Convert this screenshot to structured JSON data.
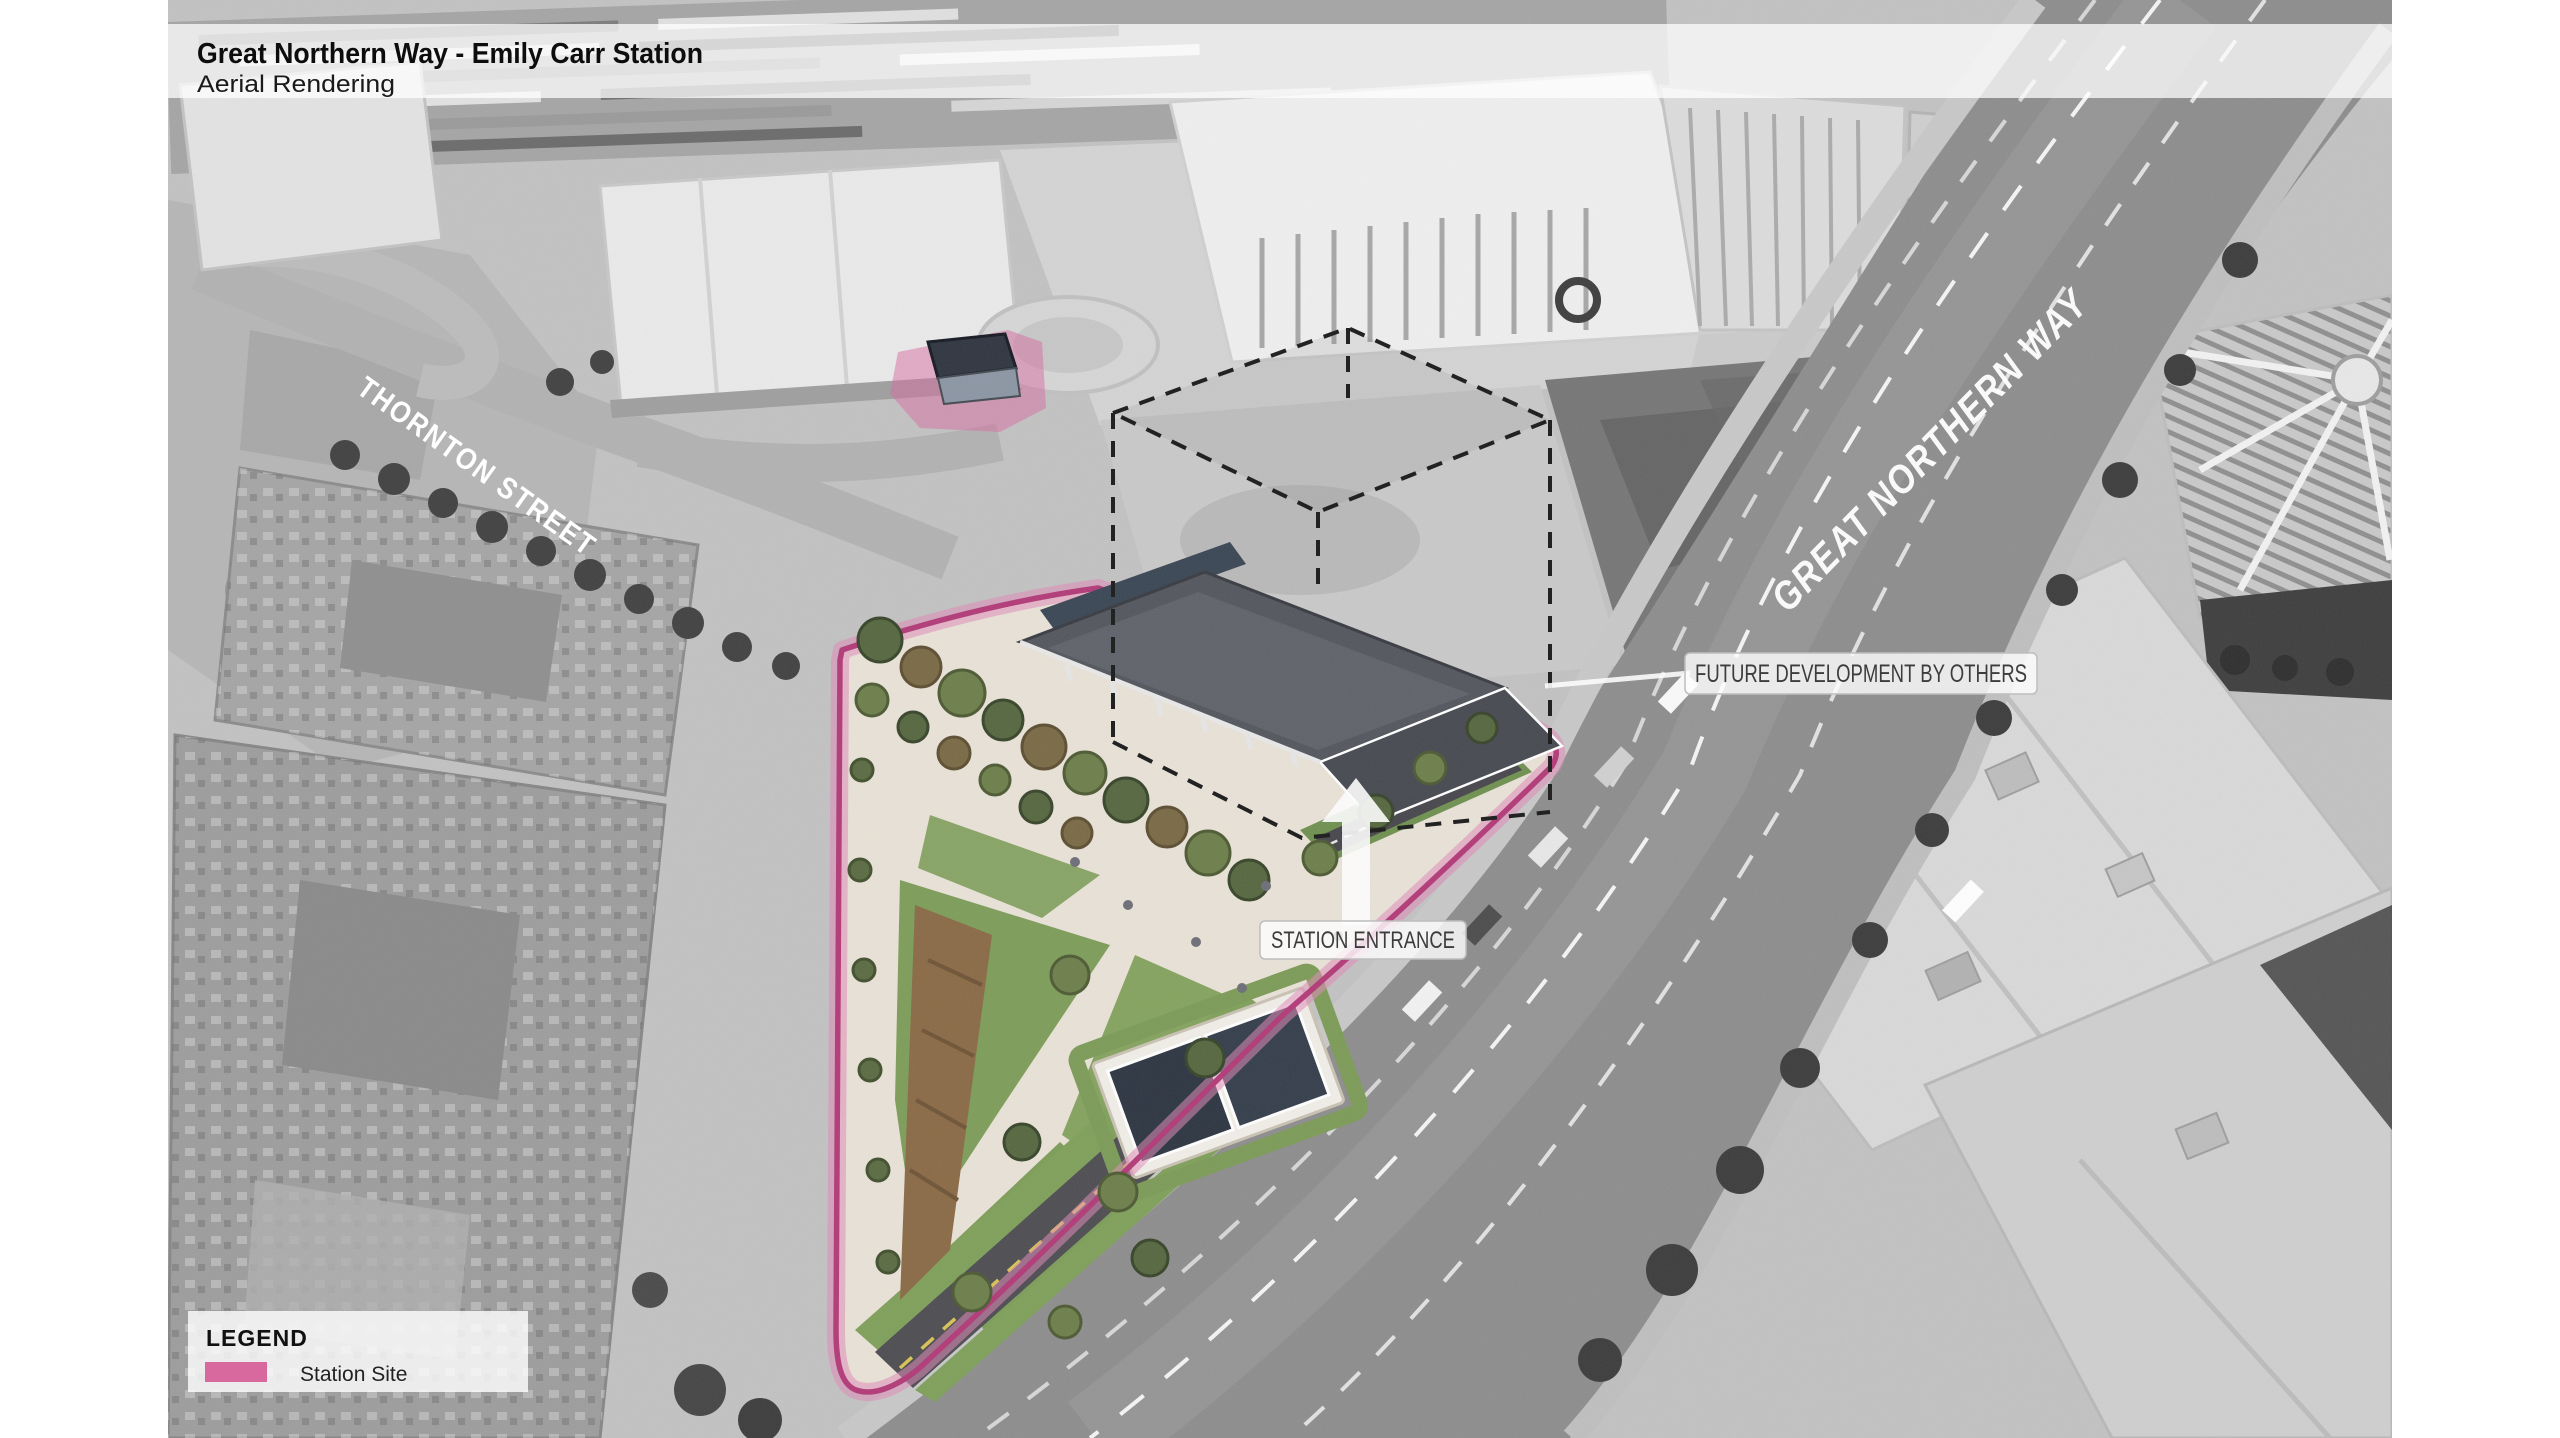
{
  "header": {
    "title": "Great Northern Way - Emily Carr Station",
    "subtitle": "Aerial Rendering"
  },
  "street_labels": {
    "thornton": "THORNTON STREET",
    "great_northern_way": "GREAT NORTHERN WAY"
  },
  "callouts": {
    "future_development": "FUTURE DEVELOPMENT BY OTHERS",
    "station_entrance": "STATION ENTRANCE"
  },
  "legend": {
    "title": "LEGEND",
    "items": [
      {
        "label": "Station Site",
        "color": "#d7699f"
      }
    ]
  },
  "colors": {
    "site_outline": "#b23a78",
    "site_halo": "#e08ab8",
    "callout_text": "#3c3c3c",
    "street_label_text": "#ffffff",
    "arrow": "#ffffff"
  }
}
